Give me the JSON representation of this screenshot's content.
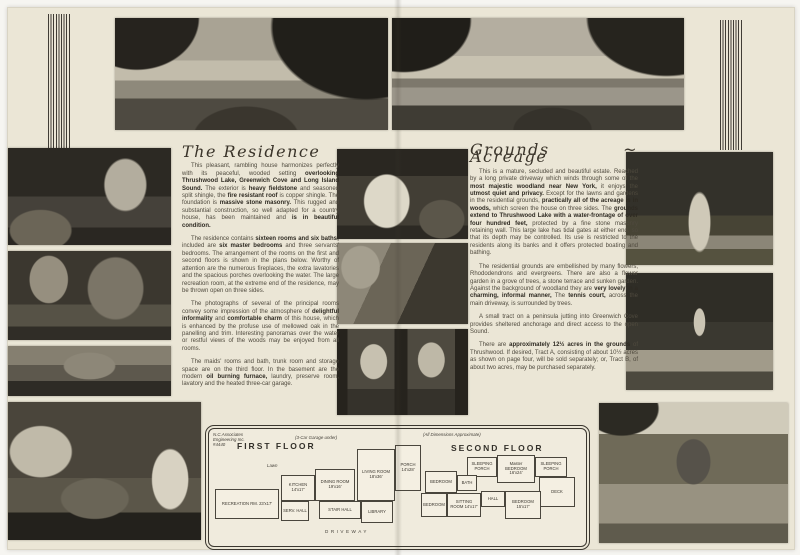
{
  "left_article": {
    "title": "The Residence",
    "paragraphs": [
      [
        {
          "t": "This pleasant, rambling house harmonizes perfectly with its peaceful, wooded setting "
        },
        {
          "t": "overlooking Thrushwood Lake, Greenwich Cove and Long Island Sound.",
          "b": true
        },
        {
          "t": " The exterior is "
        },
        {
          "t": "heavy fieldstone",
          "b": true
        },
        {
          "t": " and seasoned split shingle, the "
        },
        {
          "t": "fire resistant roof",
          "b": true
        },
        {
          "t": " is copper shingle. The foundation is "
        },
        {
          "t": "massive stone masonry.",
          "b": true
        },
        {
          "t": " This rugged and substantial construction, so well adapted for a country house, has been maintained and "
        },
        {
          "t": "is in beautiful condition.",
          "b": true
        }
      ],
      [
        {
          "t": "The residence contains "
        },
        {
          "t": "sixteen rooms and six baths;",
          "b": true
        },
        {
          "t": " included are "
        },
        {
          "t": "six master bedrooms",
          "b": true
        },
        {
          "t": " and three servants' bedrooms. The arrangement of the rooms on the first and second floors is shown in the plans below. Worthy of attention are the numerous fireplaces, the extra lavatories and the spacious porches overlooking the water. The large recreation room, at the extreme end of the residence, may be thrown open on three sides."
        }
      ],
      [
        {
          "t": "The photographs of several of the principal rooms convey some impression of the atmosphere of "
        },
        {
          "t": "delightful informality",
          "b": true
        },
        {
          "t": " and "
        },
        {
          "t": "comfortable charm",
          "b": true
        },
        {
          "t": " of this house, which is enhanced by the profuse use of mellowed oak in the panelling and trim. Interesting panoramas over the water or restful views of the woods may be enjoyed from all rooms."
        }
      ],
      [
        {
          "t": "The maids' rooms and bath, trunk room and storage space are on the third floor. In the basement are the modern "
        },
        {
          "t": "oil burning furnace,",
          "b": true
        },
        {
          "t": " laundry, preserve room, lavatory and the heated three-car garage."
        }
      ]
    ]
  },
  "right_article": {
    "title": "Grounds ~ Acreage",
    "paragraphs": [
      [
        {
          "t": "This is a mature, secluded and beautiful estate. Reached by a long private driveway which winds through some of the "
        },
        {
          "t": "most majestic woodland near New York,",
          "b": true
        },
        {
          "t": " it enjoys the "
        },
        {
          "t": "utmost quiet and privacy.",
          "b": true
        },
        {
          "t": " Except for the lawns and gardens in the residential grounds, "
        },
        {
          "t": "practically all of the acreage is in woods,",
          "b": true
        },
        {
          "t": " which screen the house on three sides. The "
        },
        {
          "t": "grounds extend to Thrushwood Lake with a water-frontage of over four hundred feet,",
          "b": true
        },
        {
          "t": " protected by a fine stone masonry retaining wall. This large lake has tidal gates at either end, so that its depth may be controlled. Its use is restricted to the residents along its banks and it offers protected boating and bathing."
        }
      ],
      [
        {
          "t": "The residential grounds are embellished by many flowers, Rhododendrons and evergreens. There are also a flower garden in a grove of trees, a stone terrace and sunken garden. Against the background of woodland they are "
        },
        {
          "t": "very lovely in a charming, informal manner,",
          "b": true
        },
        {
          "t": " The "
        },
        {
          "t": "tennis court,",
          "b": true
        },
        {
          "t": " across the main driveway, is surrounded by trees."
        }
      ],
      [
        {
          "t": "A small tract on a peninsula jutting into Greenwich Cove provides sheltered anchorage and direct access to the open Sound."
        }
      ],
      [
        {
          "t": "There are "
        },
        {
          "t": "approximately 12½ acres in the grounds",
          "b": true
        },
        {
          "t": " of Thrushwood. If desired, Tract A, consisting of about 10½ acres as shown on page four, will be sold separately; or, Tract B, of about two acres, may be purchased separately."
        }
      ]
    ]
  },
  "plan": {
    "architect_note": "N.C.Associates Engineering Inc. #4440",
    "garage_note": "(3-Car Garage under)",
    "dimensions_note": "(All Dimensions Approximate)",
    "lawn_label": "Lawn",
    "driveway_label": "DRIVEWAY",
    "first_floor": {
      "title": "FIRST FLOOR",
      "rooms": [
        "RECREATION RM. 23'x17'",
        "KITCHEN 14'x17'",
        "SERV. HALL",
        "DINING ROOM 19'x16'",
        "STAIR HALL",
        "LIVING ROOM 18'x36'",
        "LIBRARY",
        "PORCH 14'x28'"
      ]
    },
    "second_floor": {
      "title": "SECOND FLOOR",
      "rooms": [
        "SLEEPING PORCH",
        "Master BEDROOM 16'x24'",
        "SLEEPING PORCH",
        "DECK",
        "BEDROOM",
        "BATH",
        "SITTING ROOM 14'x17'",
        "BEDROOM",
        "HALL",
        "BEDROOM 15'x17'"
      ]
    }
  },
  "colors": {
    "page_background": "#ebe6d6",
    "ink": "#4f4a3e",
    "bold_ink": "#2e2a22",
    "heading_ink": "#3a342a",
    "stripe": "#403c35",
    "plan_paper": "#f0ebdd",
    "photo_dark": "#2a2721",
    "photo_light": "#c8c2b1"
  }
}
